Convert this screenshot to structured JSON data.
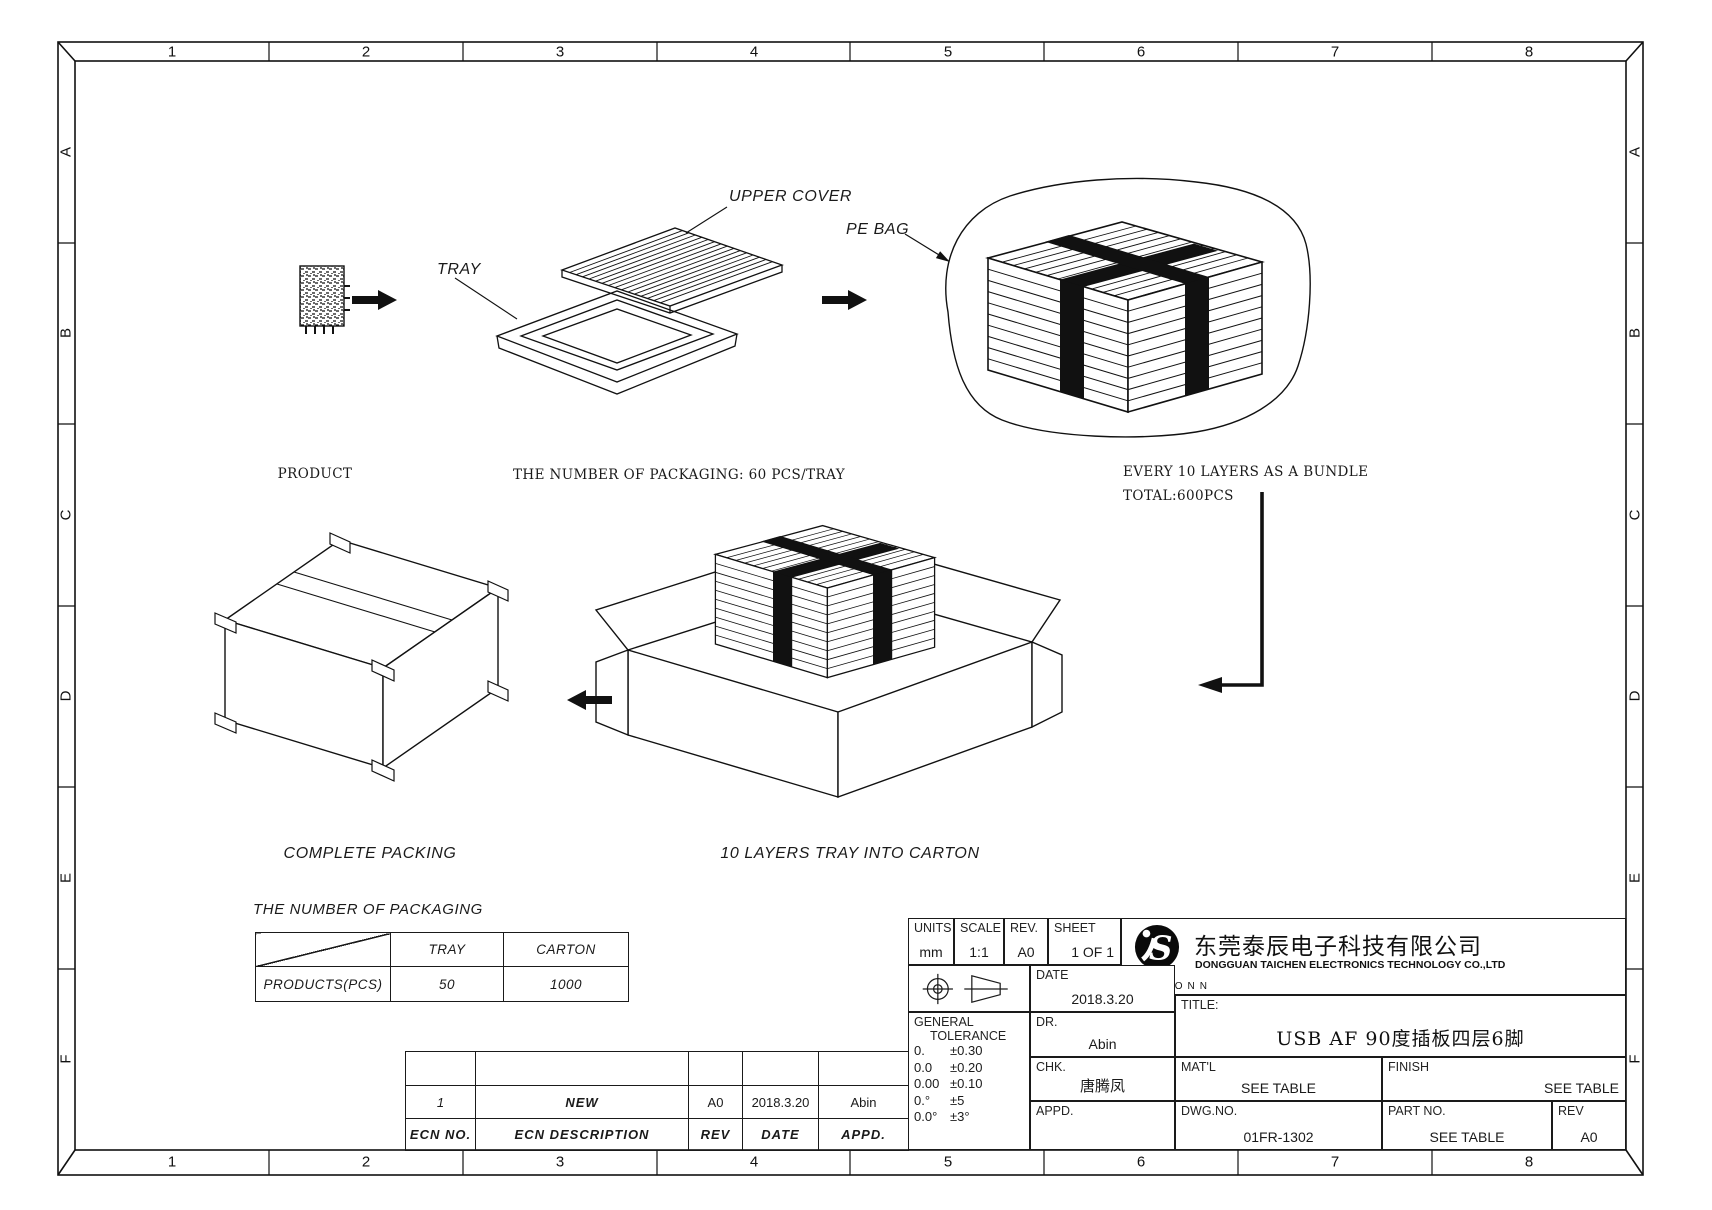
{
  "border": {
    "cols": [
      "1",
      "2",
      "3",
      "4",
      "5",
      "6",
      "7",
      "8"
    ],
    "rows": [
      "A",
      "B",
      "C",
      "D",
      "E",
      "F"
    ]
  },
  "flow": {
    "product_caption": "PRODUCT",
    "tray_label": "TRAY",
    "upper_cover_label": "UPPER COVER",
    "pe_bag_label": "PE BAG",
    "tray_caption": "THE NUMBER OF PACKAGING: 60 PCS/TRAY",
    "bundle_caption": "EVERY 10 LAYERS AS A BUNDLE",
    "bundle_total": "TOTAL:600PCS",
    "carton_caption": "10 LAYERS TRAY INTO CARTON",
    "complete_caption": "COMPLETE PACKING"
  },
  "packaging_table": {
    "title": "THE NUMBER OF PACKAGING",
    "col_tray": "TRAY",
    "col_carton": "CARTON",
    "row_label": "PRODUCTS(PCS)",
    "tray_value": "50",
    "carton_value": "1000"
  },
  "ecn_table": {
    "rows": [
      [
        "",
        "",
        "",
        "",
        ""
      ],
      [
        "1",
        "NEW",
        "A0",
        "2018.3.20",
        "Abin"
      ]
    ],
    "headers": [
      "ECN NO.",
      "ECN  DESCRIPTION",
      "REV",
      "DATE",
      "APPD."
    ]
  },
  "title_block": {
    "units_label": "UNITS",
    "units_value": "mm",
    "scale_label": "SCALE",
    "scale_value": "1:1",
    "rev_label": "REV.",
    "rev_value": "A0",
    "sheet_label": "SHEET",
    "sheet_value": "1 OF 1",
    "date_label": "DATE",
    "date_value": "2018.3.20",
    "dr_label": "DR.",
    "dr_value": "Abin",
    "chk_label": "CHK.",
    "chk_value": "唐腾凤",
    "appd_label": "APPD.",
    "appd_value": "",
    "tol_label_1": "GENERAL",
    "tol_label_2": "TOLERANCE",
    "tolerances": [
      [
        "0.",
        "±0.30"
      ],
      [
        "0.0",
        "±0.20"
      ],
      [
        "0.00",
        "±0.10"
      ],
      [
        "0.°",
        "±5"
      ],
      [
        "0.0°",
        "±3°"
      ]
    ],
    "company_cn": "东莞泰辰电子科技有限公司",
    "company_en": "DONGGUAN TAICHEN ELECTRONICS TECHNOLOGY CO.,LTD",
    "brand": "TISCONN",
    "title_label": "TITLE:",
    "title_value": "USB AF 90度插板四层6脚",
    "matl_label": "MAT'L",
    "matl_value": "SEE TABLE",
    "finish_label": "FINISH",
    "finish_value": "SEE TABLE",
    "dwg_label": "DWG.NO.",
    "dwg_value": "01FR-1302",
    "part_label": "PART NO.",
    "part_value": "SEE TABLE",
    "rev2_label": "REV",
    "rev2_value": "A0"
  }
}
